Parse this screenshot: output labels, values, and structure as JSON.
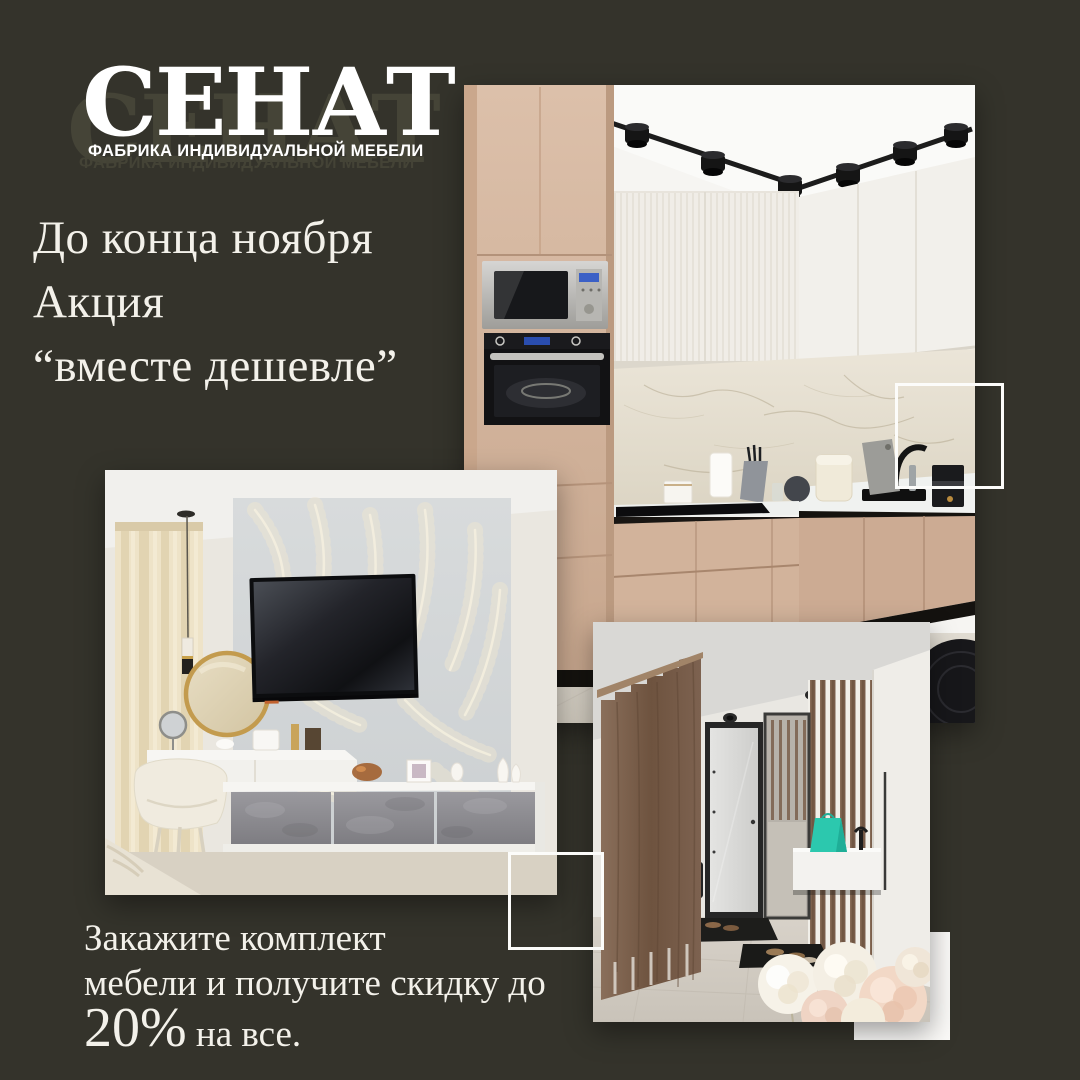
{
  "page": {
    "background": "#34332b",
    "text_color": "#f3f1ea"
  },
  "logo": {
    "brand": "СЕНАТ",
    "tagline": "ФАБРИКА ИНДИВИДУАЛЬНОЙ МЕБЕЛИ"
  },
  "promo": {
    "line1": "До конца ноября",
    "line2": "Акция",
    "line3": "“вместе дешевле”"
  },
  "offer": {
    "line1": "Закажите комплект",
    "line2": "мебели и получите скидку до",
    "highlight": "20%",
    "tail": " на все."
  }
}
